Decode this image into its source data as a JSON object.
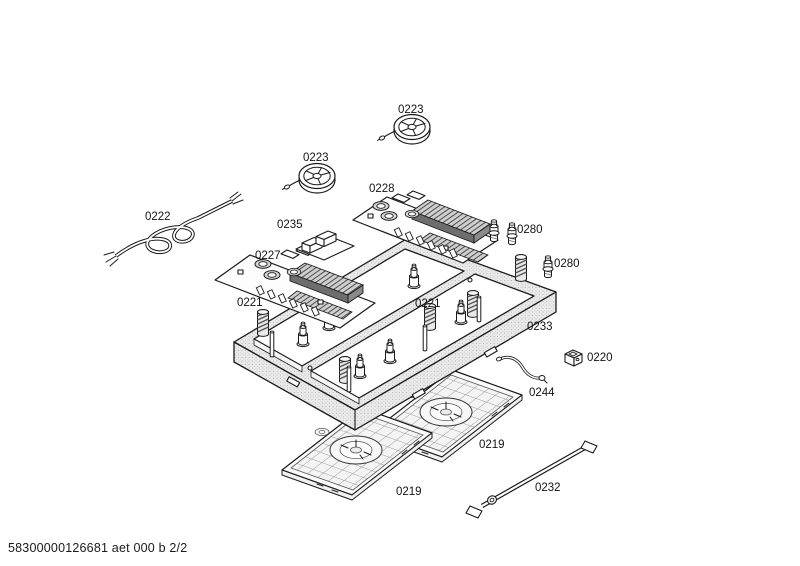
{
  "page": {
    "footer": "58300000126681 aet 000 b 2/2"
  },
  "diagram": {
    "type": "exploded-parts-diagram",
    "colors": {
      "ink": "#1a1a1a",
      "paper": "#ffffff"
    },
    "parts": {
      "fan_upper": {
        "label": "0223"
      },
      "fan_left": {
        "label": "0223"
      },
      "board_right": {
        "label": "0228"
      },
      "cable": {
        "label": "0222"
      },
      "module": {
        "label": "0235"
      },
      "board_left": {
        "label": "0227"
      },
      "bolt_a": {
        "label": "0280"
      },
      "bolt_b": {
        "label": "0280"
      },
      "spring_left": {
        "label": "0221"
      },
      "spring_right": {
        "label": "0221"
      },
      "frame": {
        "label": "0233"
      },
      "connector": {
        "label": "0220"
      },
      "wire": {
        "label": "0244"
      },
      "tray_right": {
        "label": "0219"
      },
      "tray_left": {
        "label": "0219"
      },
      "rod": {
        "label": "0232"
      }
    }
  }
}
